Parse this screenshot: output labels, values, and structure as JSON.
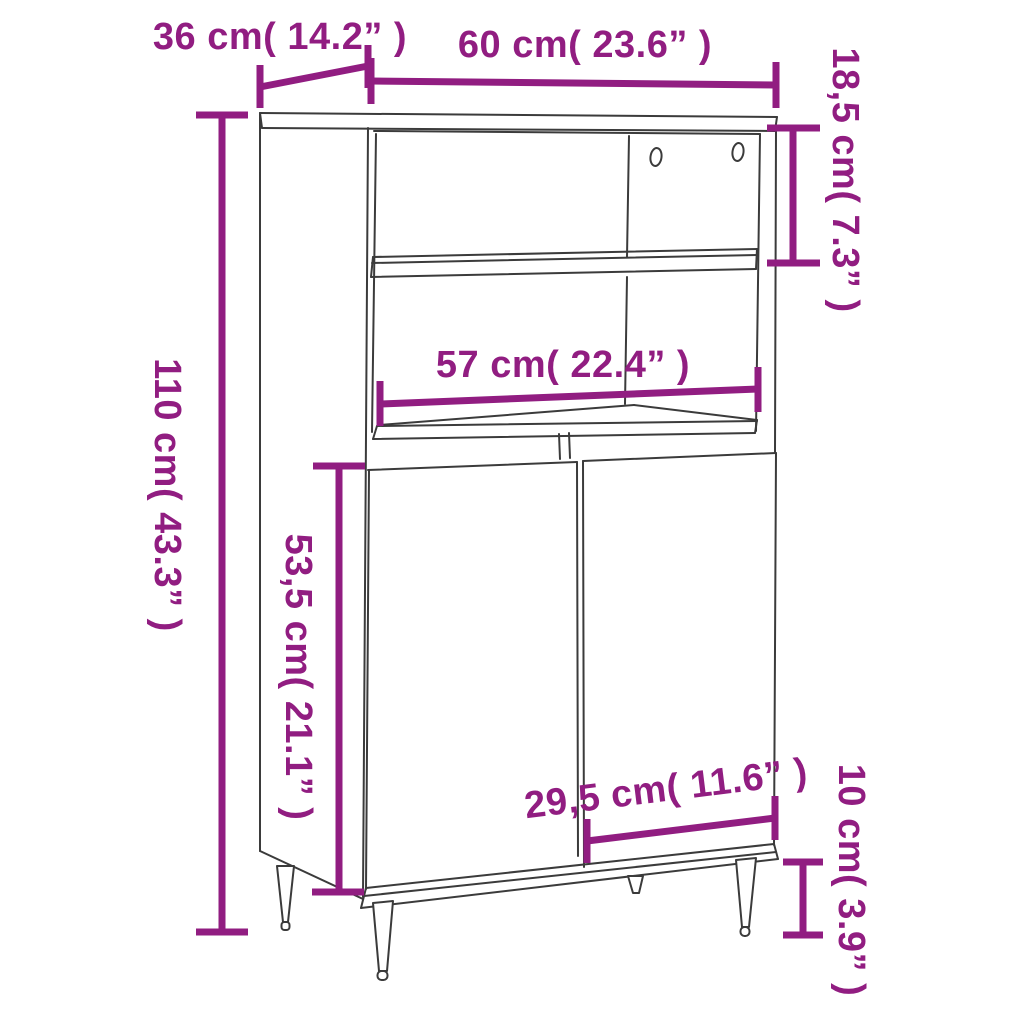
{
  "figure": {
    "subject": "highboard cabinet line drawing with open shelves, two doors and tapered legs",
    "background_color": "#ffffff",
    "outline_color": "#3b3b3b",
    "dimension_color": "#911d81"
  },
  "dimensions": [
    {
      "id": "depth",
      "label": "36 cm( 14.2” )",
      "value_cm": "36",
      "value_inch": "14.2",
      "orientation": "horizontal"
    },
    {
      "id": "width",
      "label": "60 cm( 23.6” )",
      "value_cm": "60",
      "value_inch": "23.6",
      "orientation": "horizontal"
    },
    {
      "id": "top-section-height",
      "label": "18,5 cm( 7.3” )",
      "value_cm": "18,5",
      "value_inch": "7.3",
      "orientation": "vertical"
    },
    {
      "id": "total-height",
      "label": "110 cm( 43.3” )",
      "value_cm": "110",
      "value_inch": "43.3",
      "orientation": "vertical"
    },
    {
      "id": "inner-width",
      "label": "57 cm( 22.4” )",
      "value_cm": "57",
      "value_inch": "22.4",
      "orientation": "horizontal"
    },
    {
      "id": "door-height",
      "label": "53,5 cm( 21.1” )",
      "value_cm": "53,5",
      "value_inch": "21.1",
      "orientation": "vertical"
    },
    {
      "id": "door-width",
      "label": "29,5 cm( 11.6” )",
      "value_cm": "29,5",
      "value_inch": "11.6",
      "orientation": "slanted"
    },
    {
      "id": "leg-height",
      "label": "10 cm( 3.9” )",
      "value_cm": "10",
      "value_inch": "3.9",
      "orientation": "vertical"
    }
  ]
}
